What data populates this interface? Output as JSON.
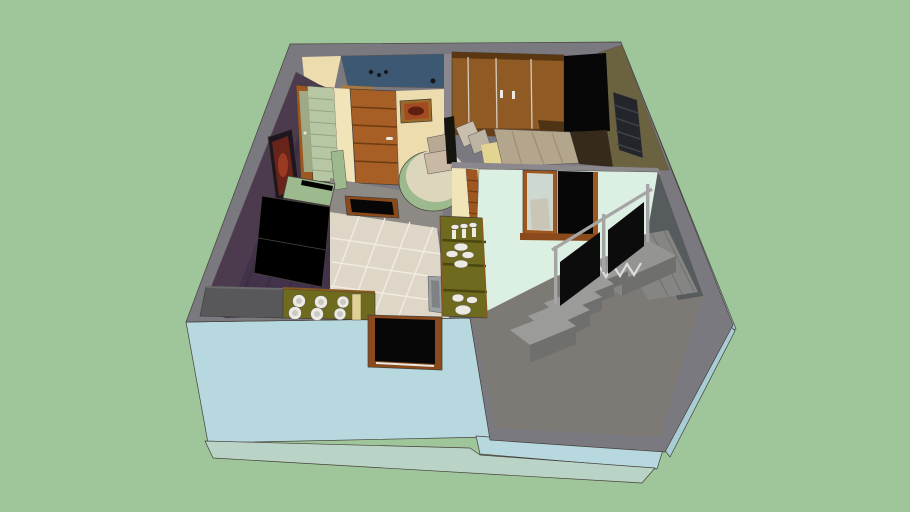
{
  "scene": {
    "title": "3D cutaway model of a small house interior, viewed from above on a green ground"
  },
  "colors": {
    "bg": "#9ec69a",
    "rim_gray": "#7b7980",
    "wall_blue": "#b6d8de",
    "wall_blue_shade": "#a9cdd4",
    "foundation": "#bad3c7",
    "cream_wall": "#ecdcae",
    "pale_yellow": "#f0e4b8",
    "bathroom_blue": "#3d5872",
    "sill_brown": "#a87840",
    "fixture_dark": "#14181c",
    "purple_wall": "#4c3a4e",
    "carpet_purple": "#42334a",
    "carpet_stripe": "#382b3e",
    "art_frame_dark": "#201620",
    "art_maroon": "#69241a",
    "art_red": "#9a3a22",
    "corridor_green": "#b7c7a3",
    "corridor_line": "#94a582",
    "glass_green": "#9fb896",
    "mat_brown": "#9a5a28",
    "door_brown": "#a85f26",
    "door_brown_dark": "#703c12",
    "frame_brown": "#a0561f",
    "frame_brown_dark": "#8a4a1c",
    "pic_frame_gold": "#9c6a28",
    "pic_art_orange": "#a34a22",
    "pic_art_dark": "#5e1f10",
    "divider_gray": "#8a888c",
    "desk_green": "#9cba8e",
    "desk_top": "#dcd6bd",
    "chair_tan": "#c9b9a4",
    "chair_tan_dark": "#b9a893",
    "wardrobe_brown": "#8f5a23",
    "wardrobe_dark": "#5a3710",
    "wardrobe_gap": "#d5ccc0",
    "wardrobe_base": "#66401a",
    "bench_dark": "#4e3414",
    "olive_wall": "#6b6340",
    "black": "#070707",
    "window_dark": "#23252a",
    "window_slat": "#3e4148",
    "shadow_dark": "#15140f",
    "pillow": "#c8bfae",
    "pillow2": "#bdb3a2",
    "bed_sheet": "#e3d491",
    "bed_blanket": "#b4a58d",
    "bed_fold": "#9c8e76",
    "bed_floor_dark": "#352a1c",
    "mint_band_gray": "#8a888c",
    "mint_wall": "#dcefe3",
    "mirror": "#cdd8d0",
    "slate_wall": "#565c5e",
    "floor_gray": "#7d7a76",
    "walkway_gray": "#8d8a85",
    "stair_top": "#9b9b99",
    "stair_front": "#6f6f6d",
    "stair_side": "#858583",
    "landing_top": "#949492",
    "rail_gray": "#a5a5a5",
    "rail_panel": "#0c0c0c",
    "stringer_white": "#dcdcda",
    "tile_floor": "#ded7c8",
    "tile_line": "#f2ece0",
    "counter_gray": "#58585a",
    "counter_gray_edge": "#6a6a6c",
    "counter_olive": "#6e6a1e",
    "counter_olive_dark": "#4c470f",
    "counter_wood_edge": "#8a5a20",
    "dish_white": "#eceae2",
    "dish_edge": "#b8b6ac",
    "dish_inner": "#c9c9c3",
    "bottle_yellow": "#e2d292",
    "sink_metal": "#9aa0a2",
    "sink_inner": "#7e8486",
    "sill_white": "#e8e8e4"
  }
}
